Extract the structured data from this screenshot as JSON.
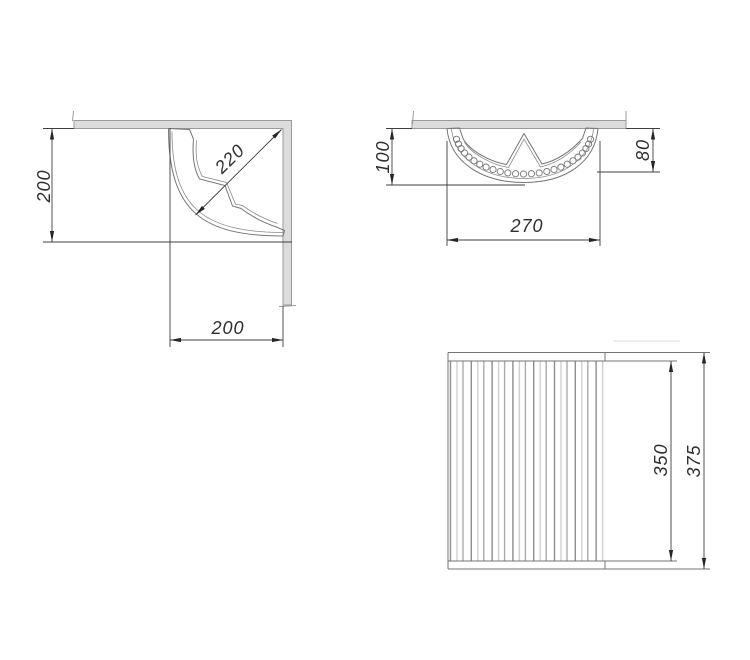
{
  "drawing": {
    "background": "#ffffff",
    "colors": {
      "outline": "#757575",
      "dimension_line": "#3f3f3f",
      "arrow": "#262626",
      "text": "#2e2e2e",
      "wall_fill": "#dcdcdc",
      "wall_stroke": "#9a9a9a",
      "slat_shades": [
        "#8e8e8e",
        "#cfcfcf",
        "#ababab"
      ]
    },
    "views": {
      "corner_top_view": {
        "dim_vertical": "200",
        "dim_diagonal": "220",
        "dim_horizontal": "200"
      },
      "front_view": {
        "dim_left_height": "100",
        "dim_right_height": "80",
        "dim_width": "270",
        "hole_count": 25
      },
      "side_view": {
        "dim_inner_height": "350",
        "dim_outer_height": "375",
        "slat_groups": 8
      }
    }
  }
}
